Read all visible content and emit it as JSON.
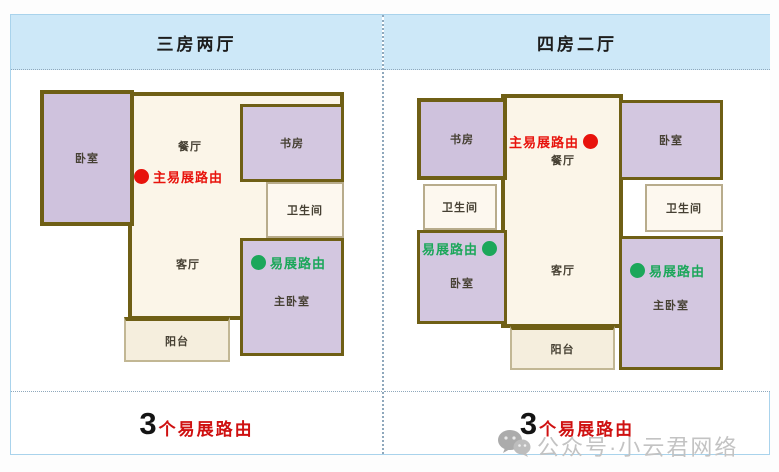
{
  "panels": [
    {
      "title": "三房两厅",
      "rooms": {
        "bedroom": "卧室",
        "dining": "餐厅",
        "study": "书房",
        "bathroom": "卫生间",
        "living": "客厅",
        "master": "主卧室",
        "balcony": "阳台"
      },
      "routers": {
        "main": {
          "label": "主易展路由"
        },
        "ext1": {
          "label": "易展路由"
        }
      },
      "footer": {
        "count": "3",
        "label": "个易展路由"
      }
    },
    {
      "title": "四房二厅",
      "rooms": {
        "study": "书房",
        "bathroom_left": "卫生间",
        "bedroom_left": "卧室",
        "dining": "餐厅",
        "living": "客厅",
        "balcony": "阳台",
        "bedroom_right": "卧室",
        "bathroom_right": "卫生间",
        "master": "主卧室"
      },
      "routers": {
        "main": {
          "label": "主易展路由"
        },
        "ext1": {
          "label": "易展路由"
        },
        "ext2": {
          "label": "易展路由"
        }
      },
      "footer": {
        "count": "3",
        "label": "个易展路由"
      }
    }
  ],
  "watermark": {
    "icon": "wechat-icon",
    "text": "公众号·小云君网络"
  },
  "colors": {
    "header_bg": "#cde8f8",
    "frame_border": "#a9d3ec",
    "divider_dotted": "#8fa8bc",
    "main_router_red": "#e8130c",
    "extender_green": "#1ba75a",
    "footer_count_black": "#141414",
    "footer_label_red": "#cf1111",
    "wall_olive": "#6f5f15",
    "room_purple": "#cfc2dd",
    "floor_cream": "#fbf5e8"
  }
}
